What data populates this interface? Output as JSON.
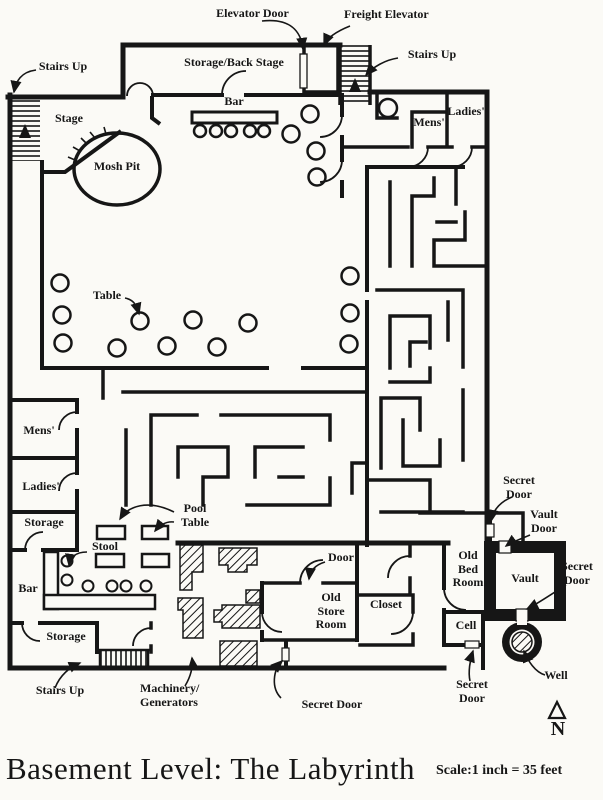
{
  "page": {
    "title": "Basement Level: The Labyrinth",
    "scale_note": "Scale:1 inch = 35 feet",
    "north_letter": "N"
  },
  "colors": {
    "ink": "#161616",
    "paper": "#fbfaf6"
  },
  "labels": {
    "elevator_door": "Elevator Door",
    "freight_elevator": "Freight Elevator",
    "stairs_up_top_right": "Stairs Up",
    "stairs_up_top_left": "Stairs Up",
    "storage_back_stage": "Storage/Back Stage",
    "bar_top": "Bar",
    "stage": "Stage",
    "mosh_pit": "Mosh Pit",
    "mens_top": "Mens'",
    "ladies_top": "Ladies'",
    "table": "Table",
    "mens_left": "Mens'",
    "ladies_left": "Ladies'",
    "storage_left": "Storage",
    "stool": "Stool",
    "bar_left": "Bar",
    "pool_table": "Pool\nTable",
    "storage_bottom": "Storage",
    "stairs_up_bottom": "Stairs Up",
    "machinery": "Machinery/\nGenerators",
    "secret_door_bottom_center": "Secret Door",
    "door": "Door",
    "old_store_room": "Old\nStore\nRoom",
    "closet": "Closet",
    "old_bed_room": "Old\nBed\nRoom",
    "cell": "Cell",
    "secret_door_top_right": "Secret\nDoor",
    "vault_door": "Vault\nDoor",
    "vault": "Vault",
    "secret_door_right": "Secret\nDoor",
    "secret_door_bottom_right": "Secret\nDoor",
    "well": "Well"
  }
}
